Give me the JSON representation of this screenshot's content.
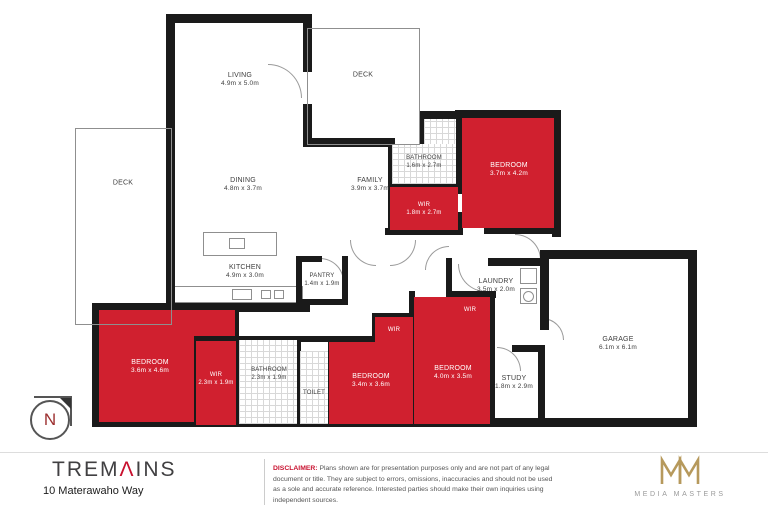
{
  "rooms": {
    "living": {
      "label": "LIVING",
      "dims": "4.9m x 5.0m"
    },
    "deck_top": {
      "label": "DECK"
    },
    "deck_left": {
      "label": "DECK"
    },
    "dining": {
      "label": "DINING",
      "dims": "4.8m x 3.7m"
    },
    "family": {
      "label": "FAMILY",
      "dims": "3.9m x 3.7m"
    },
    "kitchen": {
      "label": "KITCHEN",
      "dims": "4.9m x 3.0m"
    },
    "pantry": {
      "label": "PANTRY",
      "dims": "1.4m x 1.9m"
    },
    "bathroom_upper": {
      "label": "BATHROOM",
      "dims": "1.6m x 2.7m"
    },
    "bedroom_upper": {
      "label": "BEDROOM",
      "dims": "3.7m x 4.2m"
    },
    "wir_upper": {
      "label": "WIR",
      "dims": "1.8m x 2.7m"
    },
    "laundry": {
      "label": "LAUNDRY",
      "dims": "3.5m x 2.0m"
    },
    "garage": {
      "label": "GARAGE",
      "dims": "6.1m x 6.1m"
    },
    "study": {
      "label": "STUDY",
      "dims": "1.8m x 2.9m"
    },
    "bedroom_left": {
      "label": "BEDROOM",
      "dims": "3.6m x 4.6m"
    },
    "wir_left": {
      "label": "WIR",
      "dims": "2.3m x 1.9m"
    },
    "bathroom_lower": {
      "label": "BATHROOM",
      "dims": "2.3m x 1.9m"
    },
    "toilet": {
      "label": "TOILET"
    },
    "bedroom_mid": {
      "label": "BEDROOM",
      "dims": "3.4m x 3.6m"
    },
    "wir_mid": {
      "label": "WIR"
    },
    "bedroom_right": {
      "label": "BEDROOM",
      "dims": "4.0m x 3.5m"
    },
    "wir_right": {
      "label": "WIR"
    }
  },
  "compass": {
    "letter": "N"
  },
  "footer": {
    "brand_pre": "TREM",
    "brand_a": "Λ",
    "brand_post": "INS",
    "address": "10 Materawaho Way",
    "disclaimer_title": "DISCLAIMER:",
    "disclaimer_text": "Plans shown are for presentation purposes only and are not part of any legal document or title. They are subject to errors, omissions, inaccuracies and should not be used as a sole and accurate reference. Interested parties should make their own inquiries using independent sources.",
    "media_masters": "MEDIA MASTERS"
  },
  "colors": {
    "room_red": "#d0202f",
    "brand_red": "#c8102e",
    "logo_gold": "#b6995c"
  }
}
